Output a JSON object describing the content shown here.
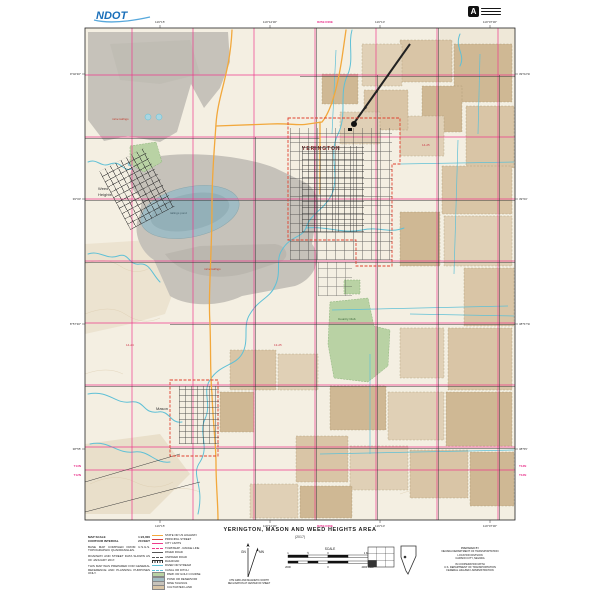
{
  "header": {
    "ndot_logo_text": "NDOT",
    "stamp_letter": "A"
  },
  "title_block": {
    "title": "YERINGTON, MASON AND WEED HEIGHTS AREA",
    "subtitle": "(2017)"
  },
  "map": {
    "town_labels": {
      "yerington": "YERINGTON",
      "weed_line1": "Weed",
      "weed_line2": "Heights",
      "mason": "Mason"
    },
    "feature_labels": {
      "tailings1": "mine tailings",
      "tailings2": "mine tailings",
      "pond": "tailings pond",
      "club": "Country Club",
      "code1": "14-25",
      "code2": "13-25",
      "code3": "14-24"
    },
    "edge": {
      "top": [
        "119°15′",
        "119°12′30″",
        "119°10′",
        "119°07′30″"
      ],
      "top_mag": "R25E  R26E",
      "bottom": [
        "119°15′",
        "119°12′30″",
        "119°10′",
        "119°07′30″"
      ],
      "bottom_mag": "R25E  R26E",
      "left": [
        "39°02′30″",
        "39°00′",
        "38°57′30″",
        "38°55′"
      ],
      "left_t1": "T13N",
      "left_t2": "T12N",
      "right": [
        "39°02′30″",
        "39°00′",
        "38°57′30″",
        "38°55′"
      ],
      "right_t1": "T13N",
      "right_t2": "T12N"
    },
    "colors": {
      "background": "#f4efe2",
      "mine_gray": "#c6c2ba",
      "pit_lake": "#a0bcc4",
      "field_tan": "#d9c5a6",
      "park_green": "#b9d2a4",
      "water_cyan": "#5fc0d6",
      "section_pink": "#ee3a8c",
      "city_red": "#e0412f",
      "highway_orange": "#f2a83c",
      "road_black": "#3a3a3a"
    }
  },
  "legend": {
    "scale_rows": [
      {
        "label": "MAP SCALE",
        "value": "1:24,000"
      },
      {
        "label": "CONTOUR INTERVAL",
        "value": "20 FEET"
      }
    ],
    "notes": [
      "BASE MAP COMPILED FROM U.S.G.S. TOPOGRAPHIC QUADRANGLES.",
      "ROADWAY AND STREET DATA SHOWN AS OF JANUARY 2017.",
      "THIS MAP WAS PREPARED FOR GENERAL REFERENCE AND PLANNING PURPOSES ONLY."
    ],
    "symbols": [
      {
        "label": "STATE OR US HIGHWAY",
        "swatch": "line",
        "color": "#f2a83c"
      },
      {
        "label": "PRINCIPAL STREET",
        "swatch": "line",
        "color": "#d94343"
      },
      {
        "label": "CITY LIMITS",
        "swatch": "line",
        "color": "#ee3a8c"
      },
      {
        "label": "TOWNSHIP - RANGE LINE",
        "swatch": "dash",
        "color": "#ee3a8c"
      },
      {
        "label": "PAVED ROAD",
        "swatch": "line",
        "color": "#555555"
      },
      {
        "label": "UNPAVED ROAD",
        "swatch": "dash",
        "color": "#555555"
      },
      {
        "label": "RAILROAD",
        "swatch": "rail",
        "color": "#333333"
      },
      {
        "label": "RIVER OR STREAM",
        "swatch": "line",
        "color": "#5fc0d6"
      },
      {
        "label": "CANAL OR DITCH",
        "swatch": "dash",
        "color": "#5fc0d6"
      },
      {
        "label": "PARK OR GOLF COURSE",
        "swatch": "box",
        "color": "#b9d2a4"
      },
      {
        "label": "POND OR RESERVOIR",
        "swatch": "box",
        "color": "#a3bdc3"
      },
      {
        "label": "MINE TAILINGS",
        "swatch": "box",
        "color": "#c8c4bc"
      },
      {
        "label": "CULTIVATED LAND",
        "swatch": "box",
        "color": "#d9c5a6"
      }
    ]
  },
  "footer": {
    "gn": "GN",
    "mn": "MN",
    "north_caption_1": "UTM GRID AND MAGNETIC NORTH",
    "north_caption_2": "DECLINATION AT CENTER OF SHEET",
    "scale_label": "SCALE",
    "miles_ticks": [
      "1",
      "½",
      "0",
      "1 MILE"
    ],
    "feet_ticks": [
      "2000",
      "0",
      "4000 FEET"
    ],
    "prepared": [
      "PREPARED BY",
      "NEVADA DEPARTMENT OF TRANSPORTATION",
      "LOCATION DIVISION",
      "CARSON CITY, NEVADA",
      "IN COOPERATION WITH",
      "U.S. DEPARTMENT OF TRANSPORTATION",
      "FEDERAL HIGHWAY ADMINISTRATION"
    ]
  }
}
